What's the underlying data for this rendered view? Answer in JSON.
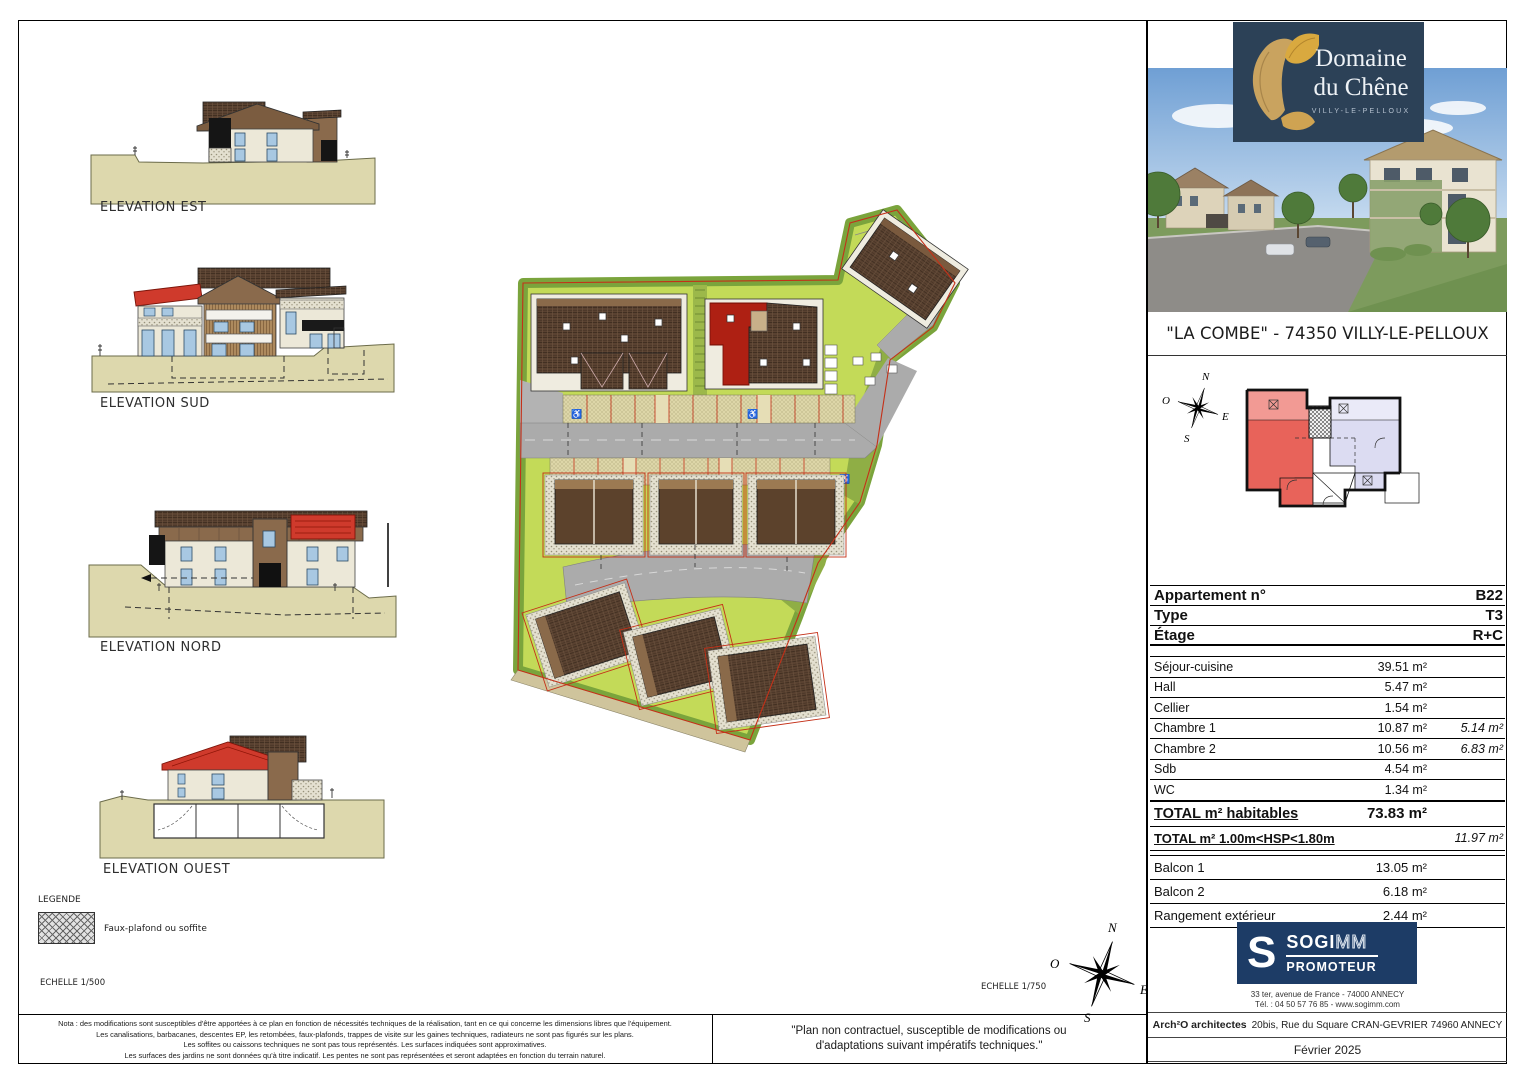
{
  "project": {
    "logo_title_line1": "Domaine",
    "logo_title_line2": "du Chêne",
    "logo_subtitle": "VILLY-LE-PELLOUX",
    "caption": "\"LA COMBE\" - 74350 VILLY-LE-PELLOUX"
  },
  "elevations": [
    {
      "label": "ELEVATION EST"
    },
    {
      "label": "ELEVATION SUD"
    },
    {
      "label": "ELEVATION NORD"
    },
    {
      "label": "ELEVATION OUEST"
    }
  ],
  "legend": {
    "title": "LEGENDE",
    "item": "Faux-plafond ou soffite"
  },
  "scales": {
    "left": "ECHELLE 1/500",
    "right": "ECHELLE 1/750"
  },
  "compass": {
    "north": "N",
    "south": "S",
    "east": "E",
    "west": "O"
  },
  "apartment": {
    "header": [
      {
        "label": "Appartement n°",
        "value": "B22"
      },
      {
        "label": "Type",
        "value": "T3"
      },
      {
        "label": "Étage",
        "value": "R+C"
      }
    ],
    "rooms": [
      {
        "label": "Séjour-cuisine",
        "area": "39.51 m²",
        "hsp": ""
      },
      {
        "label": "Hall",
        "area": "5.47 m²",
        "hsp": ""
      },
      {
        "label": "Cellier",
        "area": "1.54 m²",
        "hsp": ""
      },
      {
        "label": "Chambre 1",
        "area": "10.87 m²",
        "hsp": "5.14 m²"
      },
      {
        "label": "Chambre 2",
        "area": "10.56 m²",
        "hsp": "6.83 m²"
      },
      {
        "label": "Sdb",
        "area": "4.54 m²",
        "hsp": ""
      },
      {
        "label": "WC",
        "area": "1.34 m²",
        "hsp": ""
      }
    ],
    "totals": [
      {
        "label": "TOTAL m² habitables",
        "area": "73.83 m²",
        "hsp": ""
      },
      {
        "label": "TOTAL m² 1.00m<HSP<1.80m",
        "area": "",
        "hsp": "11.97 m²"
      }
    ],
    "annexes": [
      {
        "label": "Balcon 1",
        "area": "13.05 m²"
      },
      {
        "label": "Balcon 2",
        "area": "6.18 m²"
      },
      {
        "label": "Rangement extérieur",
        "area": "2.44 m²"
      }
    ]
  },
  "promoter": {
    "initial": "S",
    "name_bold": "SOGI",
    "name_light": "MM",
    "role": "PROMOTEUR",
    "address": "33 ter, avenue de France - 74000 ANNECY",
    "phone": "Tél. : 04 50 57 76 85 - www.sogimm.com"
  },
  "architect": {
    "name": "Arch²O architectes",
    "address": "20bis, Rue du Square CRAN-GEVRIER 74960 ANNECY"
  },
  "date": "Février 2025",
  "notes": {
    "nota": [
      "Nota : des modifications sont susceptibles d'être apportées à ce plan en fonction de nécessités techniques de la réalisation, tant en ce qui concerne les dimensions libres que l'équipement.",
      "Les canalisations, barbacanes, descentes EP, les retombées, faux-plafonds, trappes de visite sur les gaines techniques, radiateurs ne sont pas figurés sur les plans.",
      "Les soffites ou caissons techniques ne sont pas tous représentés. Les surfaces indiquées sont approximatives.",
      "Les surfaces des jardins ne sont données qu'à titre indicatif. Les pentes ne sont pas représentées et seront adaptées en fonction du terrain naturel."
    ],
    "disclaimer_line1": "\"Plan non contractuel, susceptible de modifications ou",
    "disclaimer_line2": "d'adaptations suivant impératifs techniques.\""
  },
  "colors": {
    "brand_navy": "#2c4157",
    "promoter_navy": "#1d3c66",
    "highlight_red": "#cf3a2c",
    "lawn_green": "#c3da58",
    "border_green": "#7aa43c",
    "road_gray": "#ababab",
    "ground_beige": "#ddd8ad",
    "boundary_red": "#c43018",
    "apartment_pink": "#e8635a",
    "apartment_lavender": "#dcdcf2"
  }
}
